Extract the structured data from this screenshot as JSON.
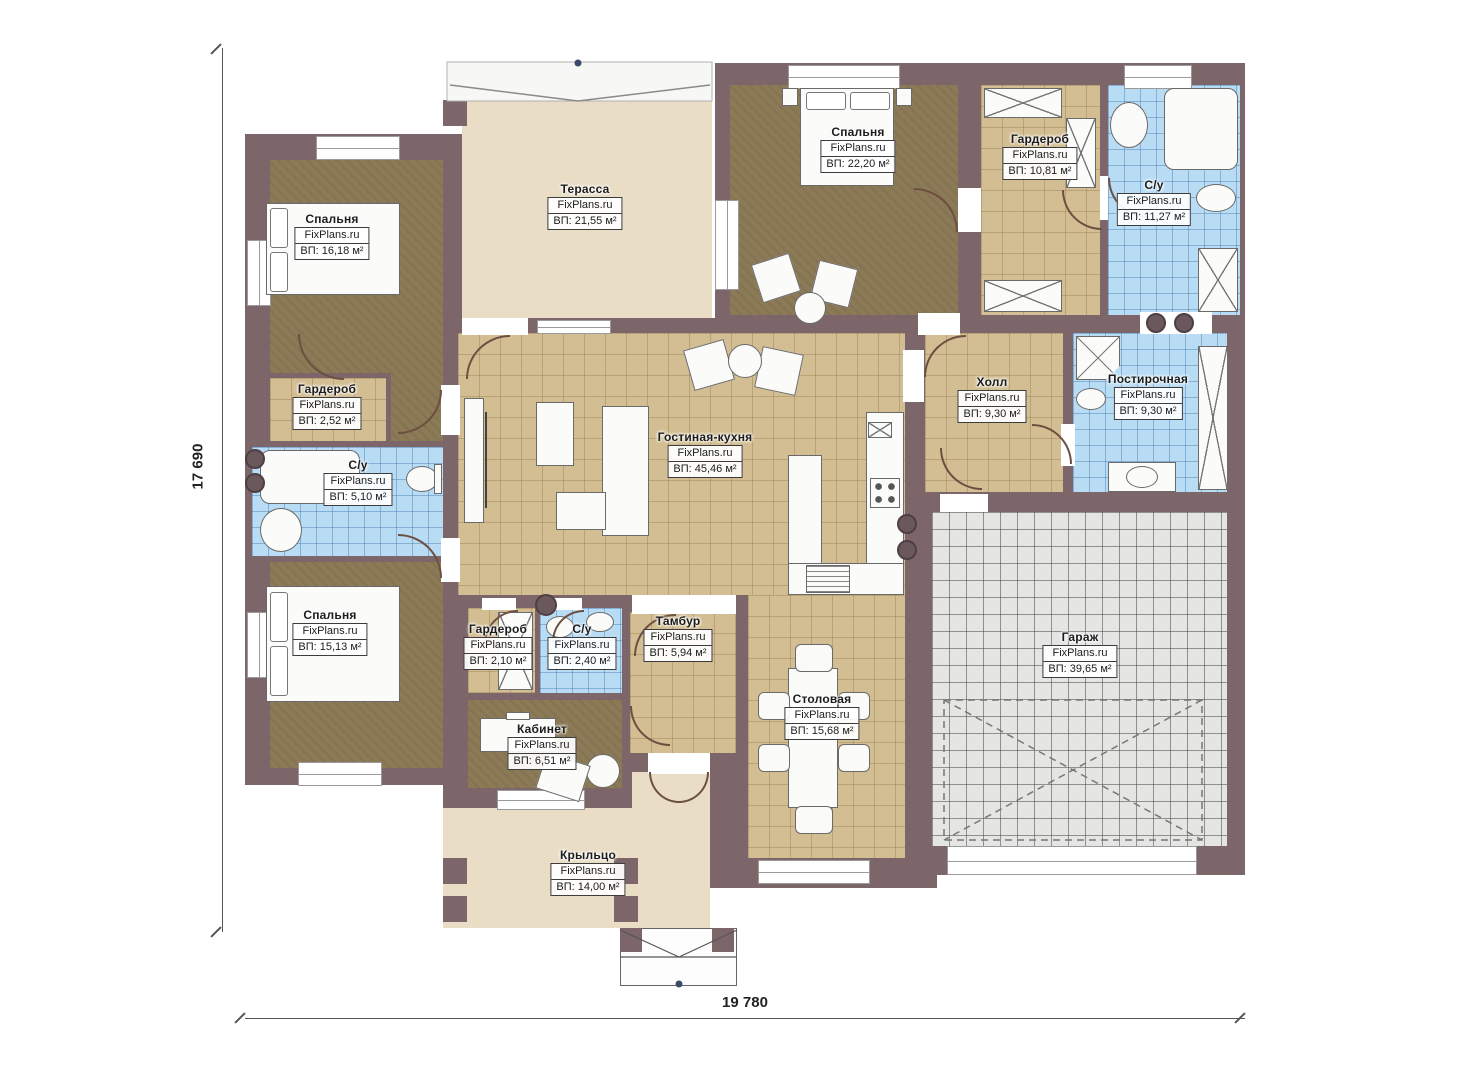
{
  "plan_title": "Одноэтажный дом — план этажа",
  "watermark": "FixPlans.ru",
  "dimensions": {
    "height_label": "17 690",
    "width_label": "19 780"
  },
  "colors": {
    "wall": "#7c666a",
    "bedroom_floor": "#8c7a57",
    "tile_floor": "#d3be93",
    "bath_floor": "#b9dcf5",
    "garage_floor": "#e5e5e3",
    "terrace_floor": "#e9ddc6"
  },
  "rooms": [
    {
      "name": "Спальня",
      "watermark": "FixPlans.ru",
      "area": "ВП: 16,18 м²"
    },
    {
      "name": "Терасса",
      "watermark": "FixPlans.ru",
      "area": "ВП: 21,55 м²"
    },
    {
      "name": "Спальня",
      "watermark": "FixPlans.ru",
      "area": "ВП: 22,20 м²"
    },
    {
      "name": "Гардероб",
      "watermark": "FixPlans.ru",
      "area": "ВП: 10,81 м²"
    },
    {
      "name": "С/у",
      "watermark": "FixPlans.ru",
      "area": "ВП: 11,27 м²"
    },
    {
      "name": "Гардероб",
      "watermark": "FixPlans.ru",
      "area": "ВП: 2,52 м²"
    },
    {
      "name": "С/у",
      "watermark": "FixPlans.ru",
      "area": "ВП: 5,10 м²"
    },
    {
      "name": "Гостиная-кухня",
      "watermark": "FixPlans.ru",
      "area": "ВП: 45,46 м²"
    },
    {
      "name": "Холл",
      "watermark": "FixPlans.ru",
      "area": "ВП: 9,30 м²"
    },
    {
      "name": "Постирочная",
      "watermark": "FixPlans.ru",
      "area": "ВП: 9,30 м²"
    },
    {
      "name": "Спальня",
      "watermark": "FixPlans.ru",
      "area": "ВП: 15,13 м²"
    },
    {
      "name": "Гардероб",
      "watermark": "FixPlans.ru",
      "area": "ВП: 2,10 м²"
    },
    {
      "name": "С/у",
      "watermark": "FixPlans.ru",
      "area": "ВП: 2,40 м²"
    },
    {
      "name": "Тамбур",
      "watermark": "FixPlans.ru",
      "area": "ВП: 5,94 м²"
    },
    {
      "name": "Столовая",
      "watermark": "FixPlans.ru",
      "area": "ВП: 15,68 м²"
    },
    {
      "name": "Гараж",
      "watermark": "FixPlans.ru",
      "area": "ВП: 39,65 м²"
    },
    {
      "name": "Кабинет",
      "watermark": "FixPlans.ru",
      "area": "ВП: 6,51 м²"
    },
    {
      "name": "Крыльцо",
      "watermark": "FixPlans.ru",
      "area": "ВП: 14,00 м²"
    }
  ]
}
